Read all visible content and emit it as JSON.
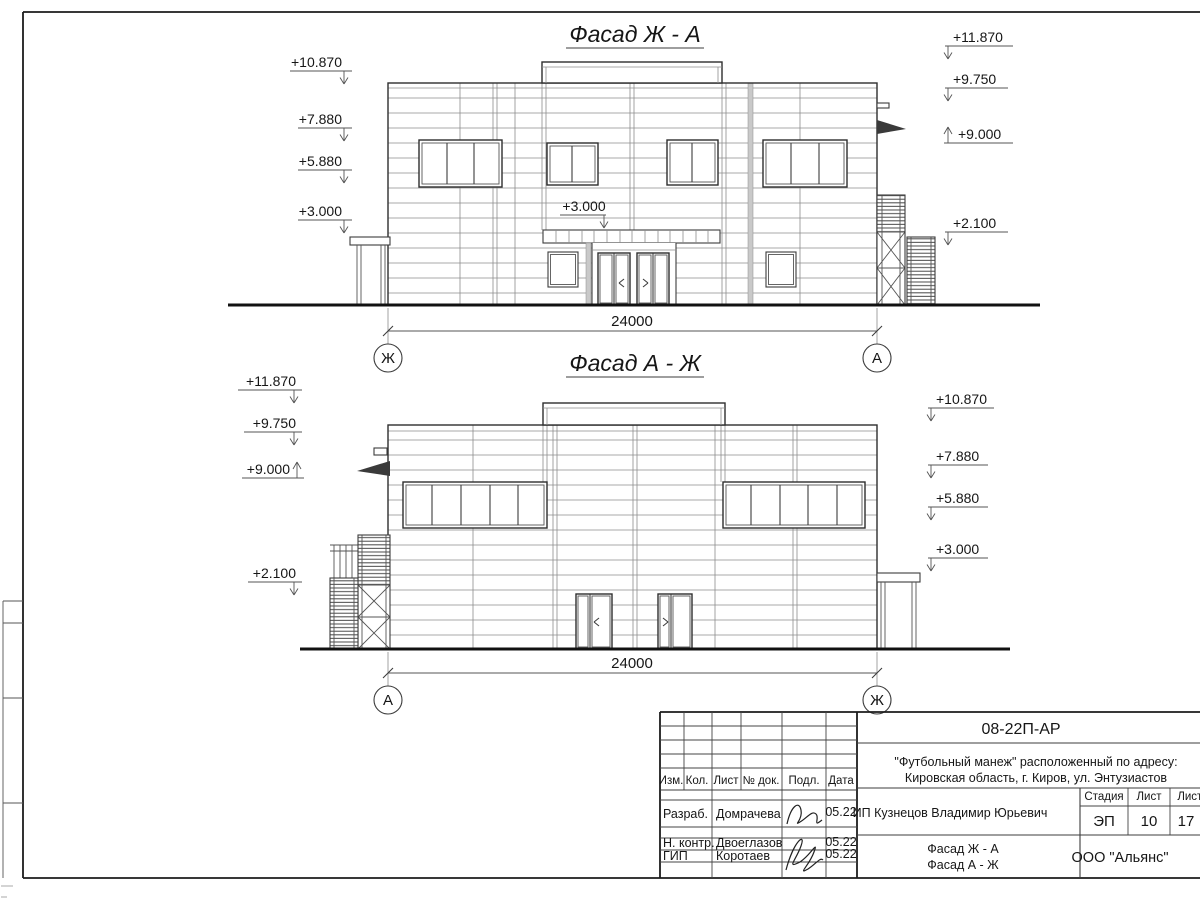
{
  "drawing": {
    "facade1": {
      "title": "Фасад Ж - А",
      "dimension": "24000",
      "axis_left": "Ж",
      "axis_right": "А",
      "marks_left": [
        "+10.870",
        "+7.880",
        "+5.880",
        "+3.000"
      ],
      "marks_right": [
        "+11.870",
        "+9.750",
        "+9.000",
        "+2.100"
      ],
      "canopy_mark": "+3.000"
    },
    "facade2": {
      "title": "Фасад А - Ж",
      "dimension": "24000",
      "axis_left": "А",
      "axis_right": "Ж",
      "marks_left": [
        "+11.870",
        "+9.750",
        "+9.000",
        "+2.100"
      ],
      "marks_right": [
        "+10.870",
        "+7.880",
        "+5.880",
        "+3.000"
      ]
    }
  },
  "titleblock": {
    "doc_code": "08-22П-АР",
    "project_line1": "\"Футбольный манеж\" расположенный по адресу:",
    "project_line2": "Кировская область, г. Киров, ул. Энтузиастов",
    "client": "ИП Кузнецов Владимир Юрьевич",
    "stage_label": "Стадия",
    "sheet_label": "Лист",
    "sheets_label": "Листов",
    "stage": "ЭП",
    "sheet_number": "10",
    "sheets_total": "17",
    "content_line1": "Фасад Ж - А",
    "content_line2": "Фасад А - Ж",
    "organization": "ООО \"Альянс\"",
    "columns": {
      "izm": "Изм.",
      "kol": "Кол.",
      "list": "Лист",
      "doc": "№ док.",
      "sign": "Подл.",
      "date": "Дата"
    },
    "rows": [
      {
        "role": "Разраб.",
        "name": "Домрачева",
        "date": "05.22"
      },
      {
        "role": "Н. контр.",
        "name": "Двоеглазов",
        "date": "05.22"
      },
      {
        "role": "ГИП",
        "name": "Коротаев",
        "date": "05.22"
      }
    ]
  }
}
